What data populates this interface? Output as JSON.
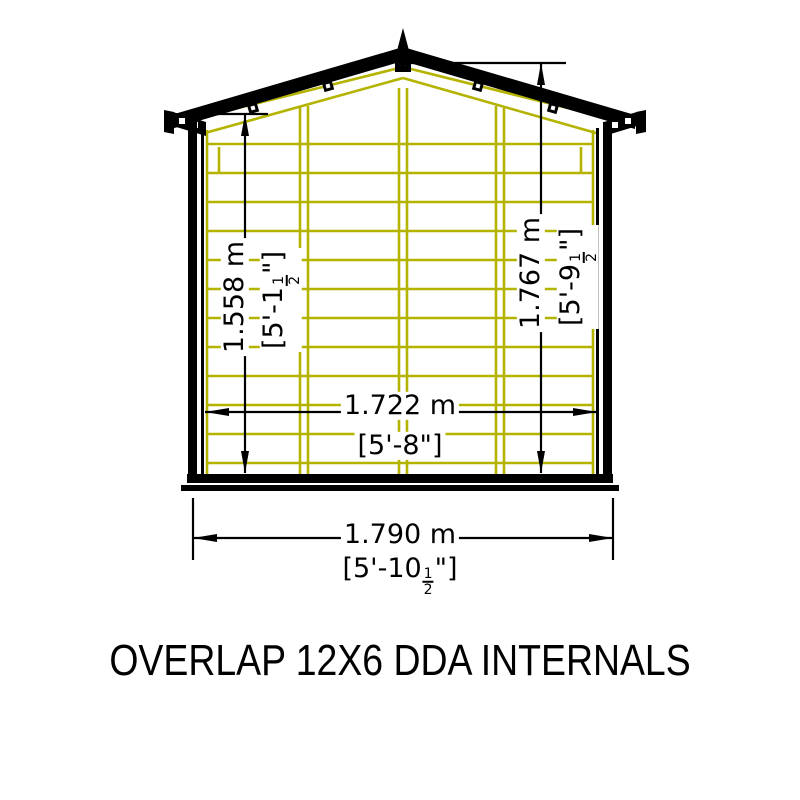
{
  "title": "OVERLAP 12X6 DDA INTERNALS",
  "colors": {
    "line_black": "#000000",
    "frame_yellow": "#b3b300",
    "background": "#ffffff"
  },
  "dimensions": {
    "left_internal_height": {
      "metric": "1.558 m",
      "imperial_prefix": "[5'-1",
      "fraction_numerator": "1",
      "fraction_denominator": "2",
      "imperial_suffix": "\"]"
    },
    "right_internal_height": {
      "metric": "1.767 m",
      "imperial_prefix": "[5'-9",
      "fraction_numerator": "1",
      "fraction_denominator": "2",
      "imperial_suffix": "\"]"
    },
    "internal_width": {
      "metric": "1.722 m",
      "imperial_prefix": "[5'-8",
      "fraction_numerator": "",
      "fraction_denominator": "",
      "imperial_suffix": "\"]"
    },
    "external_width": {
      "metric": "1.790 m",
      "imperial_prefix": "[5'-10",
      "fraction_numerator": "1",
      "fraction_denominator": "2",
      "imperial_suffix": "\"]"
    }
  }
}
